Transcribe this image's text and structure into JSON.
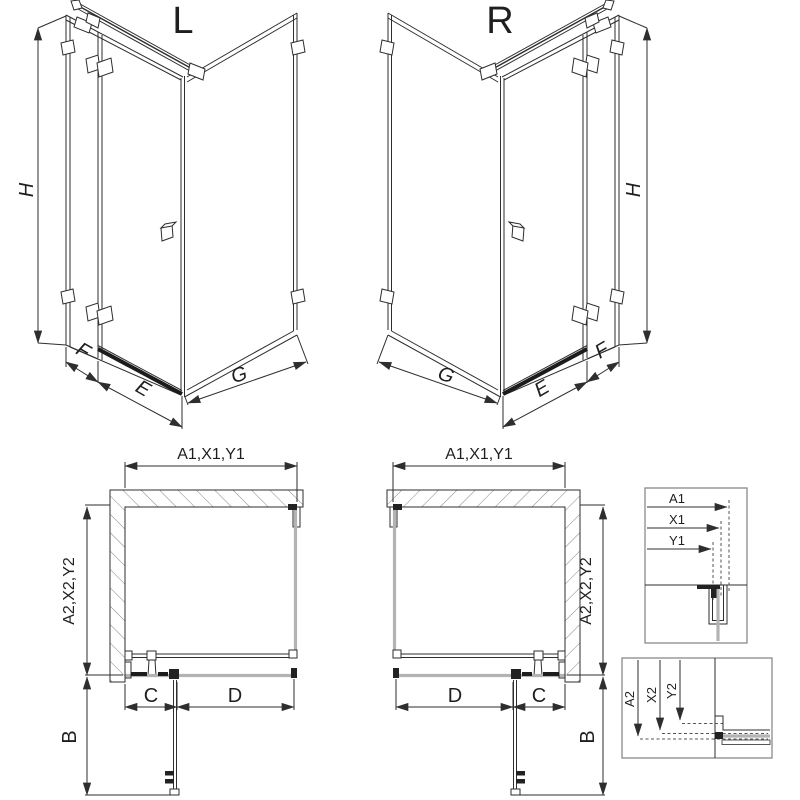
{
  "iso_left": {
    "label": "L",
    "dim_height": "H",
    "dim_fixed": "F",
    "dim_door": "E",
    "dim_side": "G"
  },
  "iso_right": {
    "label": "R",
    "dim_height": "H",
    "dim_fixed": "F",
    "dim_door": "E",
    "dim_side": "G"
  },
  "plan_left": {
    "dim_width": "A1,X1,Y1",
    "dim_depth": "A2,X2,Y2",
    "dim_fixed": "C",
    "dim_door": "D",
    "dim_swing": "B"
  },
  "plan_right": {
    "dim_width": "A1,X1,Y1",
    "dim_depth": "A2,X2,Y2",
    "dim_fixed": "C",
    "dim_door": "D",
    "dim_swing": "B"
  },
  "detail_width": {
    "dims": [
      "A1",
      "X1",
      "Y1"
    ]
  },
  "detail_depth": {
    "dims": [
      "A2",
      "X2",
      "Y2"
    ]
  },
  "colors": {
    "line": "#2e2e2e",
    "glass": "#b3b3b3",
    "dark": "#1c1c1c",
    "frame": "#8a8a8a"
  }
}
